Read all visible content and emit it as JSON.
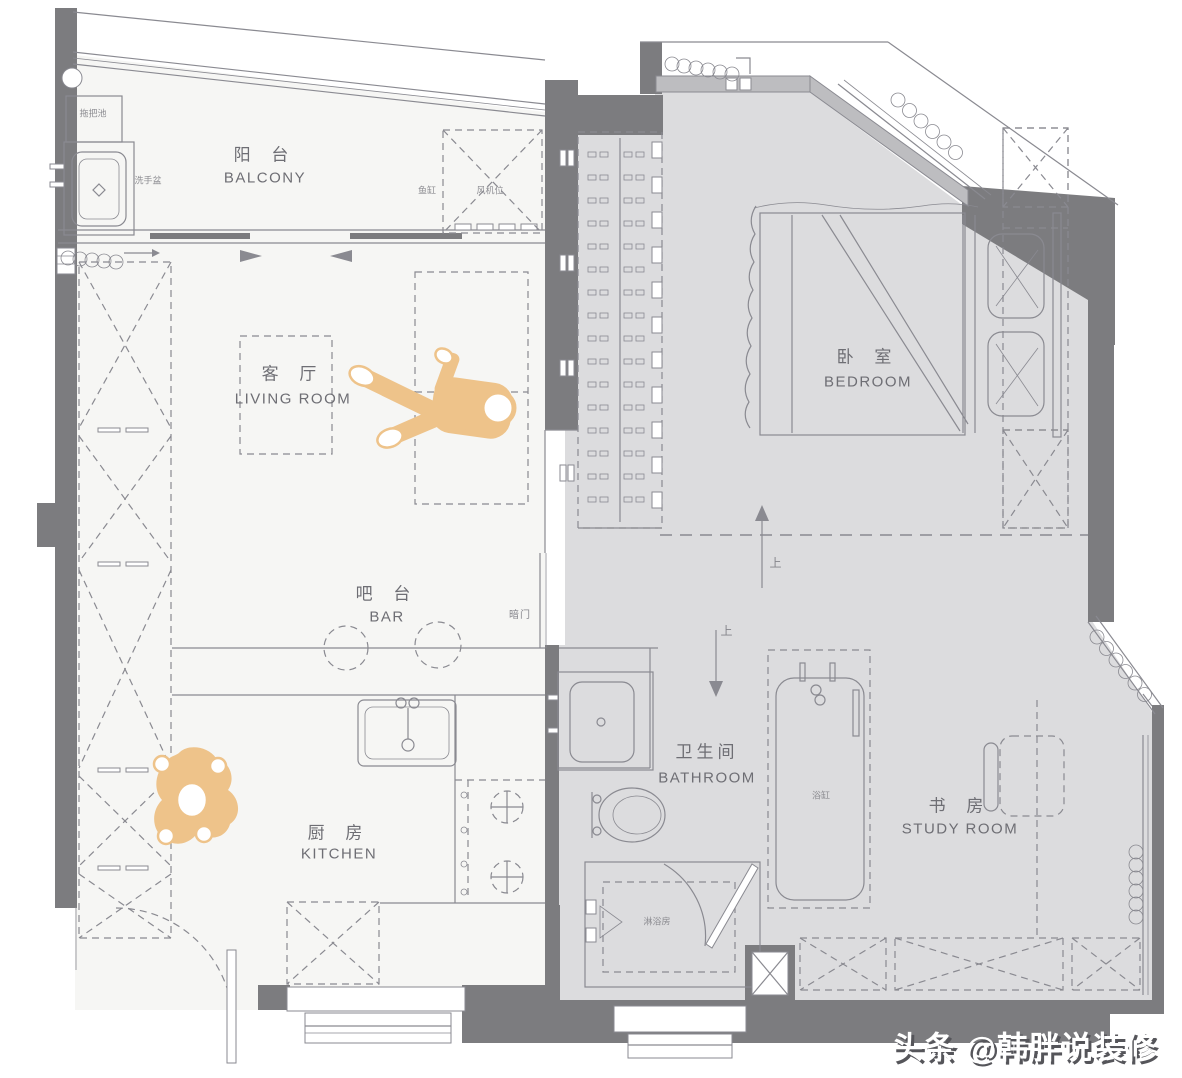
{
  "title": "apartment-floor-plan",
  "colors": {
    "wall": "#7c7c7f",
    "floor_main": "#f6f6f4",
    "floor_raised": "#dcdcde",
    "glass": "#bdbdc0",
    "line": "#8a8a91",
    "text": "#6e6e74",
    "accent": "#eec38a",
    "watermark_shadow": "#55555a"
  },
  "rooms": {
    "balcony": {
      "zh": "阳 台",
      "en": "BALCONY"
    },
    "living": {
      "zh": "客 厅",
      "en": "LIVING ROOM"
    },
    "bedroom": {
      "zh": "卧 室",
      "en": "BEDROOM"
    },
    "bar": {
      "zh": "吧 台",
      "en": "BAR"
    },
    "kitchen": {
      "zh": "厨 房",
      "en": "KITCHEN"
    },
    "bathroom": {
      "zh": "卫生间",
      "en": "BATHROOM"
    },
    "study": {
      "zh": "书 房",
      "en": "STUDY ROOM"
    }
  },
  "annotations": {
    "mop_sink": "拖把池",
    "hand_basin": "洗手盆",
    "fish_tank": "鱼缸",
    "equipment_bay": "风机位",
    "hidden_door": "暗门",
    "bathtub": "浴缸",
    "shower_room": "淋浴房",
    "step_marker": "上"
  },
  "watermark": {
    "text": "头条 @韩胖说装修"
  }
}
